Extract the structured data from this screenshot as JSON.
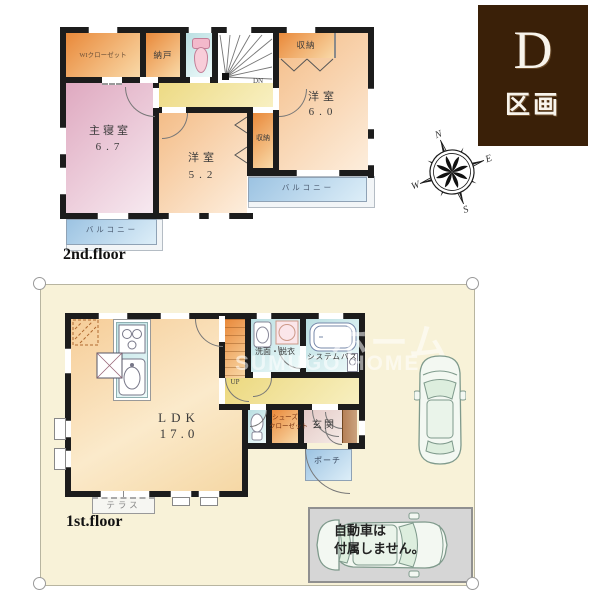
{
  "lot_badge": {
    "letter": "D",
    "label": "区画",
    "bg": "#3a2008"
  },
  "compass": {
    "n": "N",
    "e": "E",
    "s": "S",
    "w": "W"
  },
  "floor2": {
    "title": "2nd.floor",
    "walk_in_closet": "WIクローゼット",
    "storeroom": "納戸",
    "stairs_label": "DN",
    "closet": "収納",
    "bedroom1": {
      "name": "洋室",
      "size": "6.0"
    },
    "master_bedroom": {
      "name": "主寝室",
      "size": "6.7"
    },
    "bedroom2": {
      "name": "洋室",
      "size": "5.2"
    },
    "balcony": "バルコニー"
  },
  "floor1": {
    "title": "1st.floor",
    "ldk": {
      "name": "LDK",
      "size": "17.0"
    },
    "stairs_label": "UP",
    "washroom": "洗面・脱衣",
    "bath": "システムバス",
    "shoe_closet_line1": "シューズ",
    "shoe_closet_line2": "クローゼット",
    "entrance": "玄関",
    "porch": "ポーチ",
    "terrace": "テラス"
  },
  "parking": {
    "note_line1": "自動車は",
    "note_line2": "付属しません。"
  },
  "watermark": {
    "kana": "ホーム",
    "roman": "SUMUGO HOME"
  }
}
